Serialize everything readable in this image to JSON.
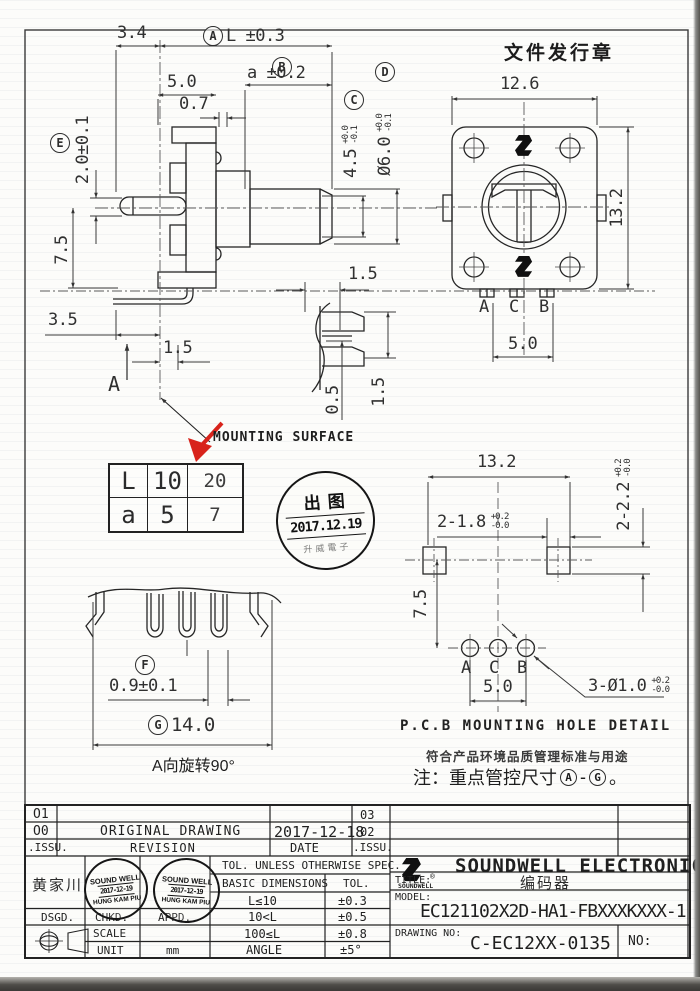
{
  "page": {
    "issuance_stamp": "文件发行章"
  },
  "front_view": {
    "dim_3_4": "3.4",
    "balloon_A": "A",
    "dim_L": "L ±0.3",
    "balloon_B": "B",
    "dim_a": "a ±0.2",
    "dim_5_0": "5.0",
    "dim_0_7": "0.7",
    "balloon_C": "C",
    "dim_4_5": "4.5",
    "tol_C_plus": "+0.0",
    "tol_C_minus": "-0.1",
    "balloon_D": "D",
    "dim_6_0": "Ø6.0",
    "tol_D_plus": "+0.0",
    "tol_D_minus": "-0.1",
    "balloon_E": "E",
    "dim_2_0": "2.0±0.1",
    "dim_7_5": "7.5",
    "dim_3_5": "3.5",
    "dim_1_5": "1.5",
    "section_label": "A"
  },
  "top_view": {
    "dim_12_6": "12.6",
    "dim_13_2": "13.2",
    "pin_a": "A",
    "pin_c": "C",
    "pin_b": "B",
    "dim_5_0": "5.0"
  },
  "shaft_detail": {
    "dim_1_5": "1.5",
    "dim_0_5": "0.5",
    "dim_1_5_v": "1.5"
  },
  "mounting": {
    "label": "MOUNTING SURFACE",
    "table": {
      "r1c1": "L",
      "r1c2": "10",
      "r1c3": "20",
      "r2c1": "a",
      "r2c2": "5",
      "r2c3": "7"
    },
    "stamp": {
      "title": "出图",
      "date": "2017.12.19",
      "arc": "升威電子"
    }
  },
  "pcb_view": {
    "dim_13_2": "13.2",
    "dim_sq_w": "2-1.8",
    "tol_w_plus": "+0.2",
    "tol_w_minus": "-0.0",
    "dim_sq_h": "2-2.2",
    "tol_h_plus": "+0.2",
    "tol_h_minus": "-0.0",
    "dim_7_5": "7.5",
    "hole_a": "A",
    "hole_c": "C",
    "hole_b": "B",
    "dim_5_0": "5.0",
    "dim_holes": "3-Ø1.0",
    "tol_holes_plus": "+0.2",
    "tol_holes_minus": "-0.0",
    "caption": "P.C.B MOUNTING HOLE DETAIL",
    "note1": "符合产品环境品质管理标准与用途",
    "note2_pre": "注：重点管控尺寸",
    "note2_a": "A",
    "note2_dash": "-",
    "note2_g": "G",
    "note2_end": "。"
  },
  "rotated_view": {
    "balloon_F": "F",
    "dim_0_9": "0.9±0.1",
    "balloon_G": "G",
    "dim_14_0": "14.0",
    "caption": "A向旋转90°"
  },
  "title_block": {
    "rev": {
      "r1_issu": "O1",
      "r1_issu2": "03",
      "r2_issu": "O0",
      "r2_name": "ORIGINAL DRAWING",
      "r2_date": "2017-12-18",
      "r2_issu2": "02",
      "r3_issu": ".ISSU.",
      "r3_name": "REVISION",
      "r3_date": "DATE",
      "r3_issu2": ".ISSU."
    },
    "designer_name": "黄家川",
    "stamp": {
      "line1": "SOUND WELL",
      "line2": "2017-12-19",
      "line3": "HUNG KAM PIU"
    },
    "dsgd": "DSGD.",
    "chkd": "CHKD.",
    "appd": "APPD.",
    "scale": "SCALE",
    "unit": "UNIT",
    "unit_value": "mm",
    "tol": {
      "header": "TOL. UNLESS OTHERWISE SPEC.",
      "col_dim": "BASIC DIMENSIONS",
      "col_tol": "TOL.",
      "r1d": "L≤10",
      "r1t": "±0.3",
      "r2d": "10<L",
      "r2t": "±0.5",
      "r3d": "100≤L",
      "r3t": "±0.8",
      "r4d": "ANGLE",
      "r4t": "±5°"
    },
    "logo_text": "SOUNDWELL",
    "reg_mark": "®",
    "company": "SOUNDWELL ELECTRONICS",
    "title_label": "TITLE:",
    "title_value": "编码器",
    "model_label": "MODEL:",
    "model_value": "EC121102X2D-HA1-FBXXXKXXX-1",
    "drawing_label": "DRAWING NO:",
    "drawing_value": "C-EC12XX-0135",
    "no_label": "NO:"
  }
}
